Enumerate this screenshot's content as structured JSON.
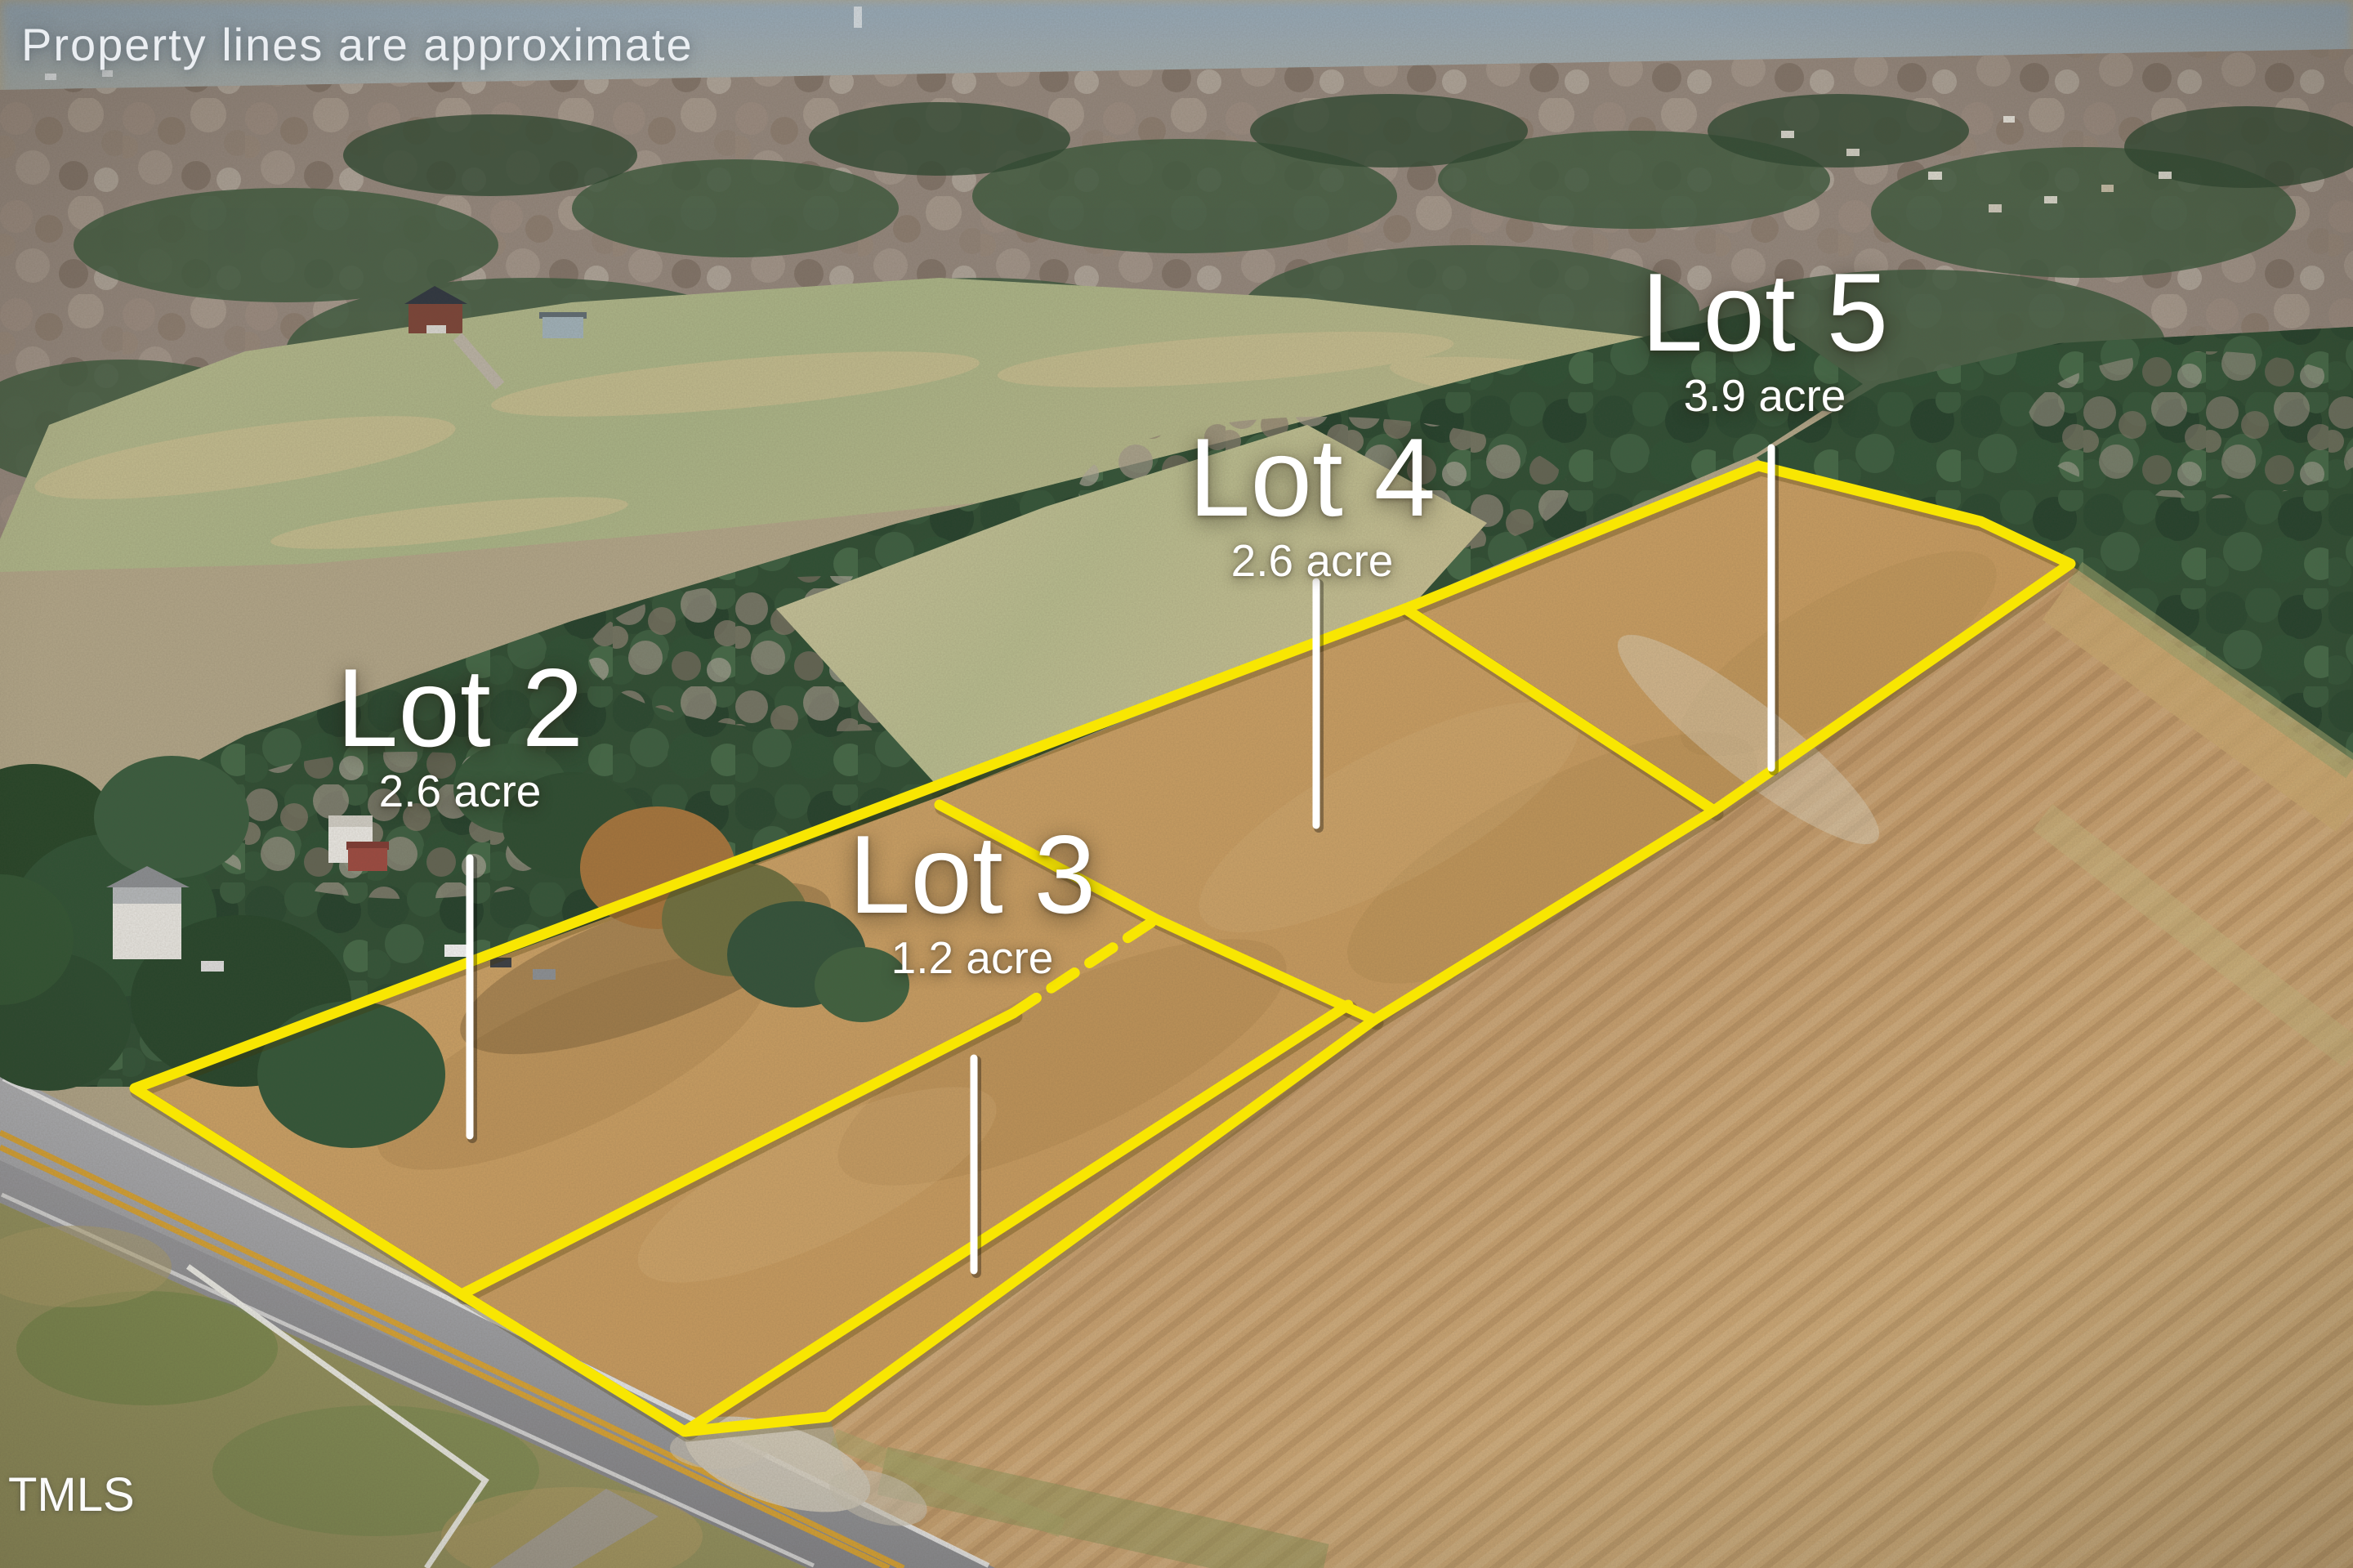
{
  "annotations": {
    "disclaimer": "Property lines are approximate",
    "watermark": "TMLS"
  },
  "lots": [
    {
      "name": "Lot 2",
      "acreage": "2.6 acre"
    },
    {
      "name": "Lot 3",
      "acreage": "1.2 acre"
    },
    {
      "name": "Lot 4",
      "acreage": "2.6 acre"
    },
    {
      "name": "Lot 5",
      "acreage": "3.9 acre"
    }
  ],
  "colors": {
    "boundary_yellow": "#f8e602",
    "pointer_white": "#ffffff"
  }
}
